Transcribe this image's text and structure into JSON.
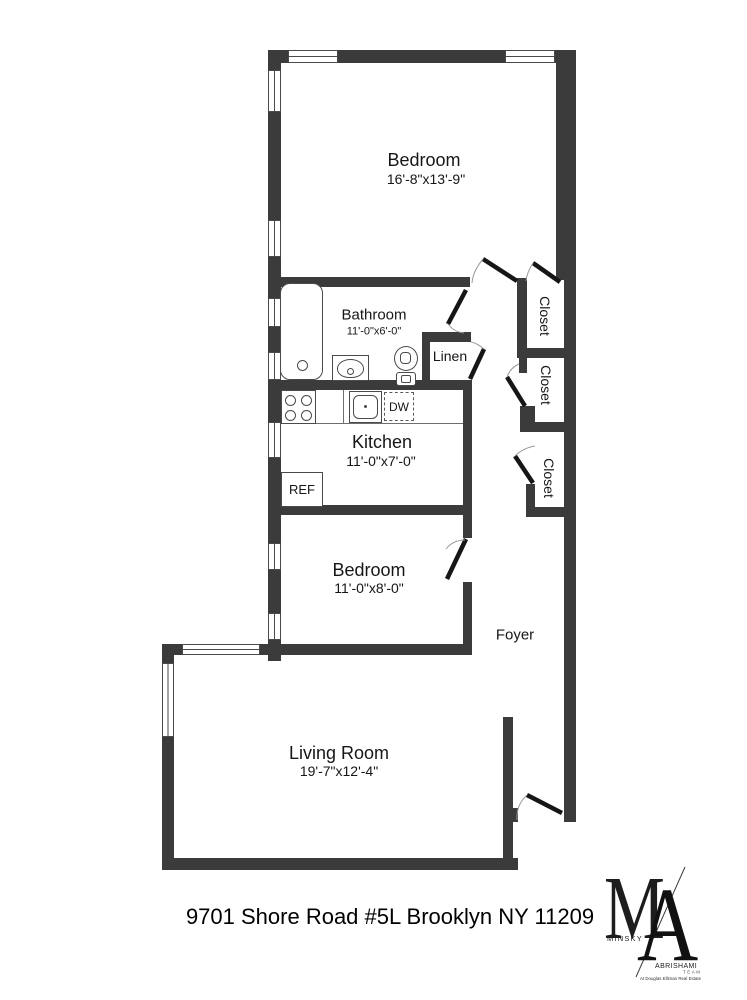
{
  "rooms": {
    "bedroom1": {
      "name": "Bedroom",
      "dims": "16'-8\"x13'-9\""
    },
    "bathroom": {
      "name": "Bathroom",
      "dims": "11'-0\"x6'-0\""
    },
    "linen": {
      "name": "Linen"
    },
    "kitchen": {
      "name": "Kitchen",
      "dims": "11'-0\"x7'-0\""
    },
    "bedroom2": {
      "name": "Bedroom",
      "dims": "11'-0\"x8'-0\""
    },
    "living_room": {
      "name": "Living Room",
      "dims": "19'-7\"x12'-4\""
    },
    "foyer": {
      "name": "Foyer"
    },
    "closet_top": {
      "name": "Closet"
    },
    "closet_middle": {
      "name": "Closet"
    },
    "closet_bottom": {
      "name": "Closet"
    }
  },
  "appliances": {
    "refrigerator": "REF",
    "dishwasher": "DW"
  },
  "footer": {
    "address": "9701 Shore Road #5L Brooklyn NY 11209"
  },
  "logo": {
    "monogram_m": "M",
    "monogram_a": "A",
    "name_line1": "MINSKY",
    "name_line2": "ABRISHAMI",
    "team": "TEAM",
    "tagline": "At Douglas Elliman Real Estate"
  },
  "colors": {
    "wall": "#3b3b3b",
    "door_leaf": "#161616",
    "door_arc": "#9a9a9a"
  }
}
